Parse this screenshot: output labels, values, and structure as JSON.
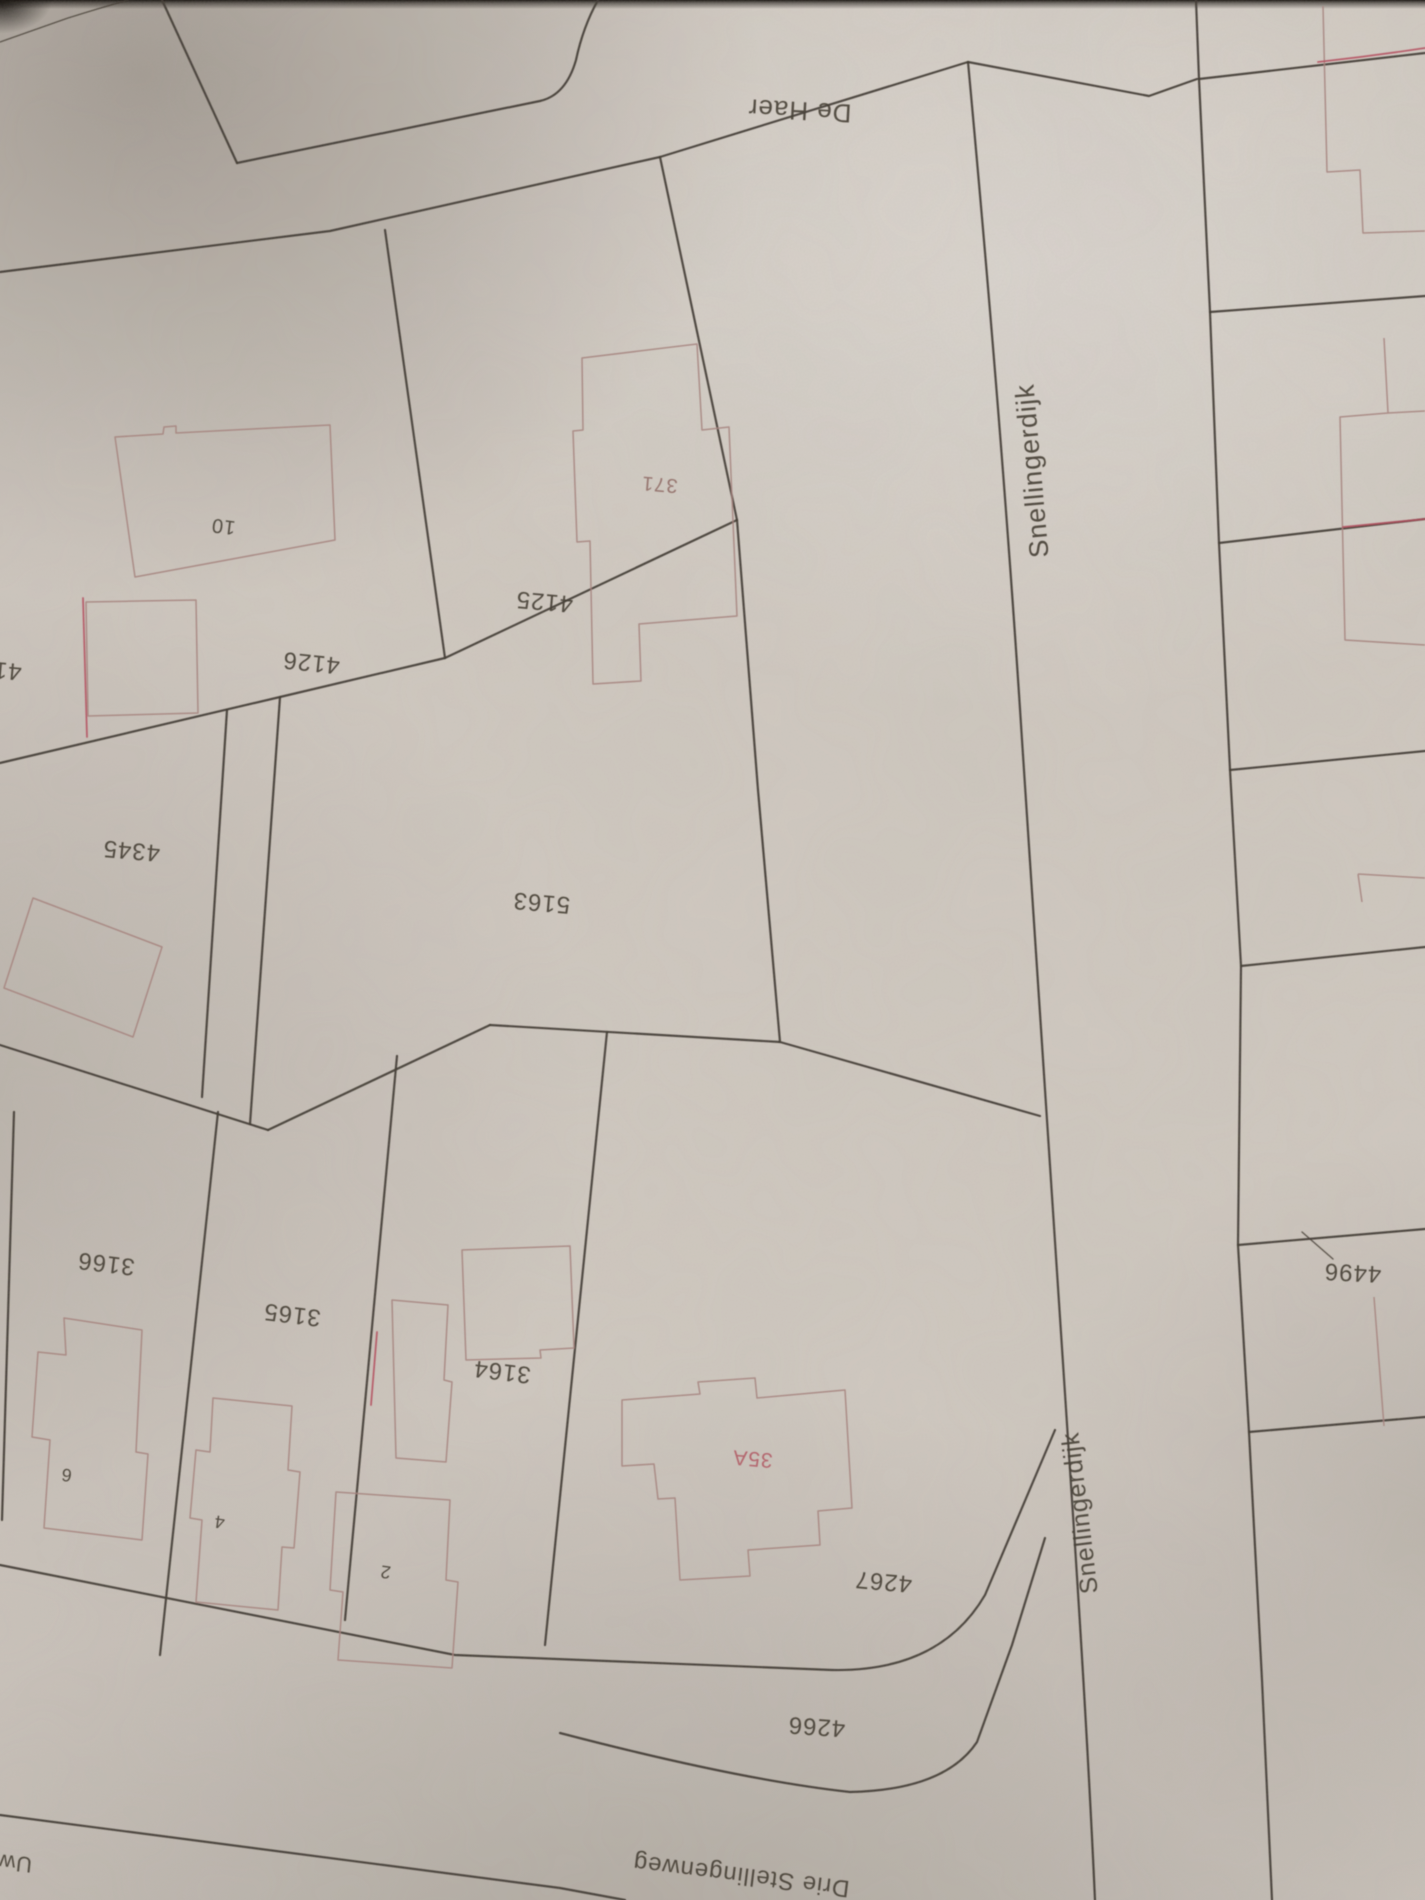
{
  "map": {
    "type": "cadastral-map-photograph",
    "colors": {
      "paper": "#cfc8c0",
      "ink": "#3f382f",
      "building_outline": "#a5807b",
      "red_marking": "#b5495a",
      "house_number_muted": "#8f6a64",
      "house_number_red": "#b25663"
    },
    "streets": [
      {
        "name": "street-label-de-haer",
        "text": "De Haer",
        "x": 800,
        "y": 102,
        "rot": 183,
        "size": 26
      },
      {
        "name": "street-label-snellingerdijk-top",
        "text": "Snellingerdijk",
        "x": 1041,
        "y": 470,
        "rot": -95,
        "size": 27
      },
      {
        "name": "street-label-snellingerdijk-bottom",
        "text": "Snellingerdijk",
        "x": 1088,
        "y": 1512,
        "rot": -97,
        "size": 25
      },
      {
        "name": "street-label-drie-stellingenweg",
        "text": "Drie Stellingenweg",
        "x": 742,
        "y": 1868,
        "rot": 187,
        "size": 24
      },
      {
        "name": "street-label-uw-cut",
        "text": "Uw",
        "x": 16,
        "y": 1856,
        "rot": 186,
        "size": 22
      }
    ],
    "parcels": [
      {
        "name": "parcel-label-4126",
        "text": "4126",
        "x": 312,
        "y": 655,
        "rot": 186,
        "size": 24
      },
      {
        "name": "parcel-label-4125",
        "text": "4125",
        "x": 545,
        "y": 594,
        "rot": 185,
        "size": 24
      },
      {
        "name": "parcel-label-41-cut",
        "text": "41",
        "x": 8,
        "y": 663,
        "rot": 185,
        "size": 24
      },
      {
        "name": "parcel-label-4345",
        "text": "4345",
        "x": 132,
        "y": 843,
        "rot": 185,
        "size": 24
      },
      {
        "name": "parcel-label-5163",
        "text": "5163",
        "x": 542,
        "y": 895,
        "rot": 185,
        "size": 24
      },
      {
        "name": "parcel-label-3166",
        "text": "3166",
        "x": 107,
        "y": 1256,
        "rot": 187,
        "size": 24
      },
      {
        "name": "parcel-label-3165",
        "text": "3165",
        "x": 293,
        "y": 1307,
        "rot": 187,
        "size": 24
      },
      {
        "name": "parcel-label-3164",
        "text": "3164",
        "x": 503,
        "y": 1364,
        "rot": 187,
        "size": 24
      },
      {
        "name": "parcel-label-4267",
        "text": "4267",
        "x": 884,
        "y": 1574,
        "rot": 185,
        "size": 24
      },
      {
        "name": "parcel-label-4266",
        "text": "4266",
        "x": 817,
        "y": 1719,
        "rot": 184,
        "size": 24
      },
      {
        "name": "parcel-label-4496",
        "text": "4496",
        "x": 1353,
        "y": 1265,
        "rot": 183,
        "size": 24
      }
    ],
    "house_numbers": [
      {
        "name": "house-number-10",
        "text": "10",
        "x": 224,
        "y": 520,
        "rot": 187,
        "size": 20
      },
      {
        "name": "house-number-371",
        "text": "371",
        "x": 660,
        "y": 478,
        "rot": 185,
        "size": 20,
        "color": "#8f6a64"
      },
      {
        "name": "house-number-6",
        "text": "6",
        "x": 67,
        "y": 1469,
        "rot": 188,
        "size": 18
      },
      {
        "name": "house-number-4",
        "text": "4",
        "x": 220,
        "y": 1516,
        "rot": 188,
        "size": 18
      },
      {
        "name": "house-number-2",
        "text": "2",
        "x": 386,
        "y": 1566,
        "rot": 188,
        "size": 18
      },
      {
        "name": "house-number-35A",
        "text": "35A",
        "x": 753,
        "y": 1452,
        "rot": 185,
        "size": 21,
        "color": "#b25663"
      }
    ]
  }
}
